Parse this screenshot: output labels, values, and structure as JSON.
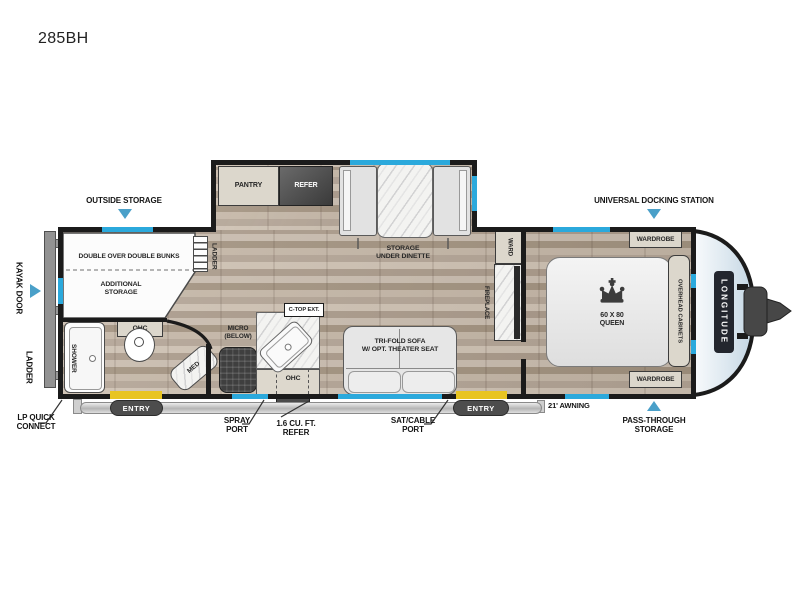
{
  "title": "285BH",
  "colors": {
    "window": "#2BA9DC",
    "arrow": "#4AA0C9",
    "step": "#E8C421"
  },
  "callouts": {
    "outside_storage": "OUTSIDE STORAGE",
    "universal_docking": "UNIVERSAL DOCKING STATION",
    "kayak_door": "KAYAK DOOR",
    "ladder_rear": "LADDER",
    "lp_quick_connect": "LP QUICK\nCONNECT",
    "spray_port": "SPRAY\nPORT",
    "exterior_refer": "1.6 CU. FT.\nREFER",
    "sat_cable_port": "SAT/CABLE\nPORT",
    "awning": "21' AWNING",
    "pass_through": "PASS-THROUGH\nSTORAGE",
    "entry_left": "ENTRY",
    "entry_right": "ENTRY"
  },
  "interior": {
    "bunks": "DOUBLE OVER DOUBLE BUNKS",
    "additional_storage": "ADDITIONAL\nSTORAGE",
    "bunk_ladder": "LADDER",
    "shower": "SHOWER",
    "bath_ohc": "OHC",
    "med": "MED",
    "pantry": "PANTRY",
    "refer": "REFER",
    "storage_under_dinette": "STORAGE\nUNDER DINETTE",
    "micro": "MICRO\n(BELOW)",
    "ctop_ext": "C-TOP EXT.",
    "kitchen_ohc": "OHC",
    "sofa": "TRI-FOLD SOFA\nW/ OPT. THEATER SEAT",
    "fireplace": "FIREPLACE",
    "ward": "WARD",
    "wardrobe_top": "WARDROBE",
    "wardrobe_bottom": "WARDROBE",
    "bed": "60 X 80\nQUEEN",
    "overhead_cabinets": "OVERHEAD CABINETS",
    "brand": "LONGITUDE"
  }
}
